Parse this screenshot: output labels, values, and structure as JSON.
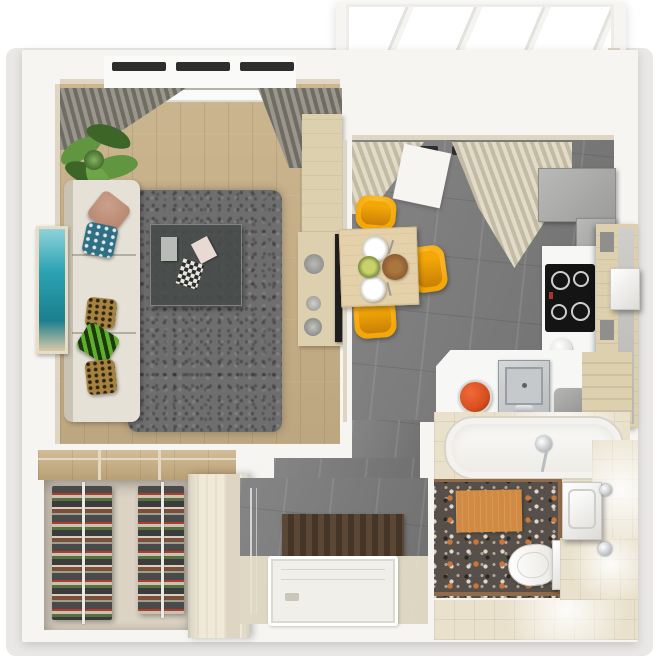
{
  "scene": {
    "title": "3d-top-view-apartment-floor-plan",
    "rooms": [
      {
        "name": "living-room",
        "items": [
          "window",
          "gray-curtains",
          "potted-plant",
          "beige-sofa",
          "throw-pillows",
          "teal-wall-art",
          "gray-shag-rug",
          "glass-coffee-table",
          "wood-console",
          "wall-tv"
        ]
      },
      {
        "name": "kitchen-dining",
        "items": [
          "window",
          "cream-curtains",
          "gray-upper-cabinets",
          "cooktop",
          "white-counter",
          "tall-wood-cabinet",
          "boiler",
          "steel-sink",
          "tomato-bowl",
          "dining-table",
          "yellow-chairs",
          "plates",
          "salad-bowl",
          "bread-basket",
          "pots"
        ]
      },
      {
        "name": "balcony",
        "items": [
          "glazed-windows",
          "diagonal-tile-floor",
          "two-armchairs",
          "round-black-table"
        ]
      },
      {
        "name": "walk-in-closet",
        "items": [
          "wood-shelf-top",
          "clothes-rack-left",
          "clothes-rack-right",
          "cream-wardrobe"
        ]
      },
      {
        "name": "shower-room",
        "items": [
          "gray-tile-floor",
          "glass-panel",
          "slatted-wood-mat",
          "white-shower-tray"
        ]
      },
      {
        "name": "bathroom",
        "items": [
          "bathtub",
          "shower-head",
          "terrazzo-floor",
          "orange-bath-mat",
          "toilet",
          "vanity-sink",
          "cream-tile-walls"
        ]
      }
    ]
  },
  "colors": {
    "white": "#ffffff",
    "ground": "#e9e8e6",
    "wall": "#f6f5f2",
    "cream_face": "#ded6c2",
    "wood_floor": "#c8b188",
    "closet_wood": "#c8ad7f",
    "closet_floor": "#dcd3c4",
    "rug": "#6e6e6e",
    "sofa": "#e6e1d6",
    "sofa_shadow": "#c9c3b4",
    "pillow_brown": "#b57f68",
    "pillow_blue": "#2f6f83",
    "pillow_green": "#5fae2e",
    "pillow_leopard": "#a5823f",
    "art_teal": "#2ba3b3",
    "art_frame": "#e6ddc4",
    "plant_green": "#61953f",
    "plant_dark": "#3c6527",
    "curtain_gray_a": "#9a968c",
    "curtain_gray_b": "#6f6c63",
    "curtain_cream_a": "#e2dbc8",
    "curtain_cream_b": "#c3bba4",
    "kitchen_tile": "#7c7c7c",
    "balcony_tile": "#8e8d8a",
    "balcony_chair": "#d9d7d1",
    "balcony_table": "#2b2b2b",
    "chair_yellow": "#f4a808",
    "chair_yellow_hi": "#ffc845",
    "dining_wood": "#e4d1a9",
    "cabinet_gray": "#9c9c9a",
    "counter_white": "#f7f7f5",
    "cooktop_black": "#141414",
    "steel": "#b9bcbe",
    "tomato": "#d84e1f",
    "console_wood": "#ddd0ae",
    "tv_black": "#1e1e1e",
    "wardrobe_cream": "#f0e9d8",
    "shower_tray": "#f1efe9",
    "mat_brown": "#5b4736",
    "mat_brown_dark": "#453527",
    "terrazzo_base": "#57504a",
    "terrazzo_orange": "#c9763c",
    "terrazzo_light": "#ded6c8",
    "bath_cream": "#e9e1cc",
    "orange_mat": "#d08a42",
    "trim_brown": "#8f6b49",
    "salad_green": "#8fae2c",
    "bread_brown": "#8a5a30"
  }
}
